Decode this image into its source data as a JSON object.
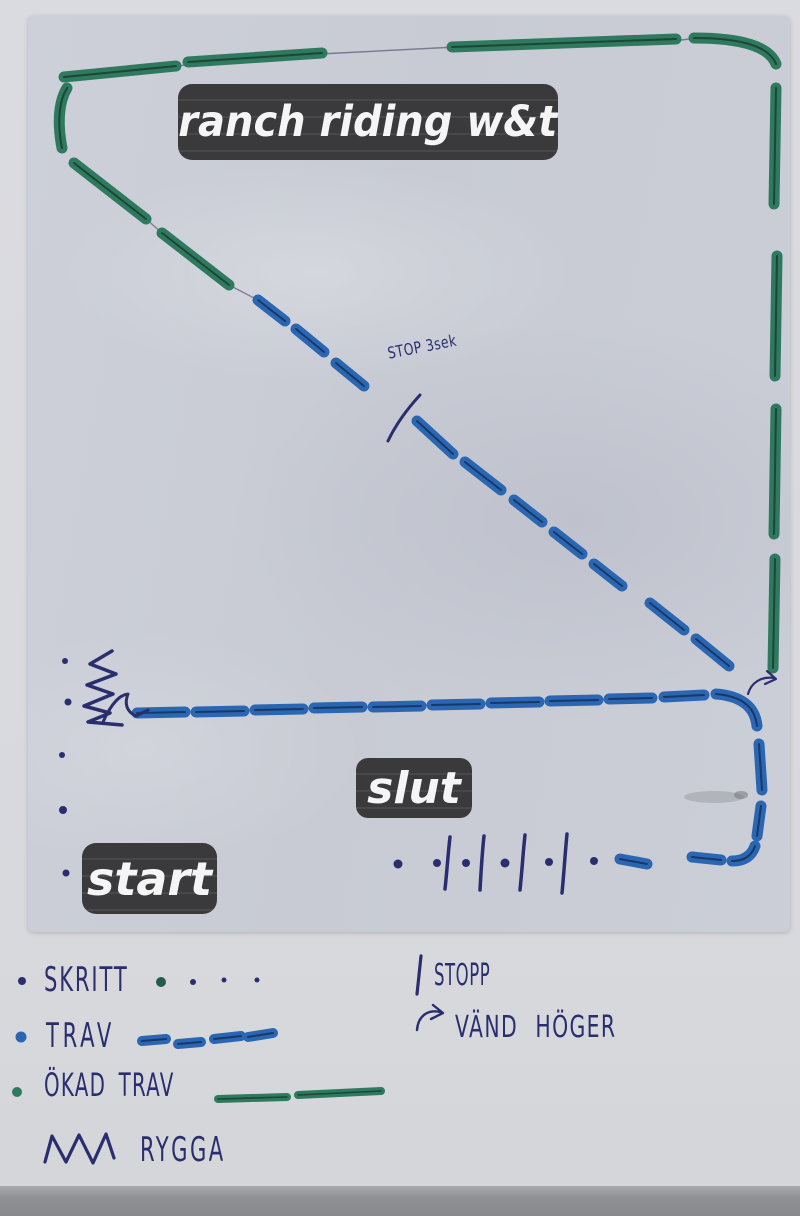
{
  "title": "ranch riding w&t",
  "arena": {
    "start_label": "start",
    "end_label": "slut",
    "stop_note": "STOP 3sek"
  },
  "legend": {
    "left": [
      {
        "label": "SKRITT",
        "symbol": "walk-dots"
      },
      {
        "label": "TRAV",
        "symbol": "blue-marker-dashes"
      },
      {
        "label": "ÖKAD TRAV",
        "symbol": "green-marker-dashes"
      },
      {
        "label": "RYGGA",
        "symbol": "zigzag"
      }
    ],
    "right": [
      {
        "label": "STOPP",
        "symbol": "vertical-bar"
      },
      {
        "label": "VÄND HÖGER",
        "symbol": "right-turn-arrow"
      }
    ]
  },
  "colors": {
    "trot_blue": "#2a66b2",
    "trot_blue_core": "#13294f",
    "ext_trot_green": "#2f7a5e",
    "ext_trot_green_core": "#163a2e",
    "walk_dot_green": "#235c48",
    "ink": "#2b2e6e",
    "label_box_bg": "#3a3a3d",
    "label_text": "#f5f5f5",
    "paper": "#c9ccd5",
    "table_band": "#8f9094"
  }
}
